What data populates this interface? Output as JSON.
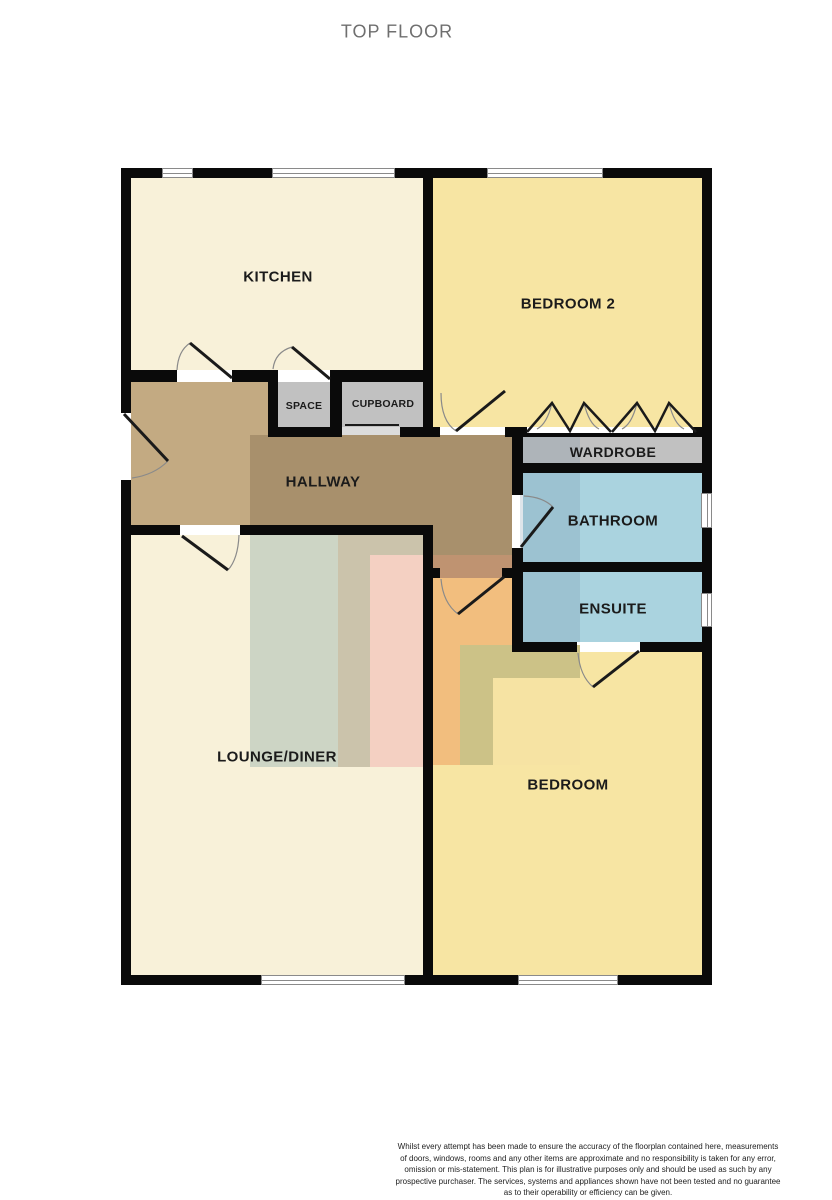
{
  "title": "TOP FLOOR",
  "rooms": {
    "kitchen": {
      "label": "KITCHEN"
    },
    "bedroom2": {
      "label": "BEDROOM 2"
    },
    "hallway": {
      "label": "HALLWAY"
    },
    "space": {
      "label": "SPACE"
    },
    "cupboard": {
      "label": "CUPBOARD"
    },
    "wardrobe": {
      "label": "WARDROBE"
    },
    "bathroom": {
      "label": "BATHROOM"
    },
    "ensuite": {
      "label": "ENSUITE"
    },
    "lounge_diner": {
      "label": "LOUNGE/DINER"
    },
    "bedroom": {
      "label": "BEDROOM"
    }
  },
  "colors": {
    "wall": "#0a0a0a",
    "kitchen_lounge_floor": "#F8F1D9",
    "bedroom_floor": "#F7E5A3",
    "bathroom_floor": "#AAD3DF",
    "storage_floor": "#C1C1C1",
    "hallway_light": "#C3AA82",
    "hallway_dark": "#A8906C",
    "title_text": "#6F6F6F",
    "label_text": "#1B1B1B"
  },
  "disclaimer": {
    "lines": [
      "Whilst every attempt has been made to ensure the accuracy of the floorplan contained here, measurements",
      "of doors, windows, rooms and any other items are approximate and no responsibility is taken for any error,",
      "omission or mis-statement. This plan is for illustrative purposes only and should be used as such by any",
      "prospective purchaser. The services, systems and appliances shown have not been tested and no guarantee",
      "as to their operability or efficiency can be given.",
      "Made with Metropix ©2026"
    ]
  }
}
